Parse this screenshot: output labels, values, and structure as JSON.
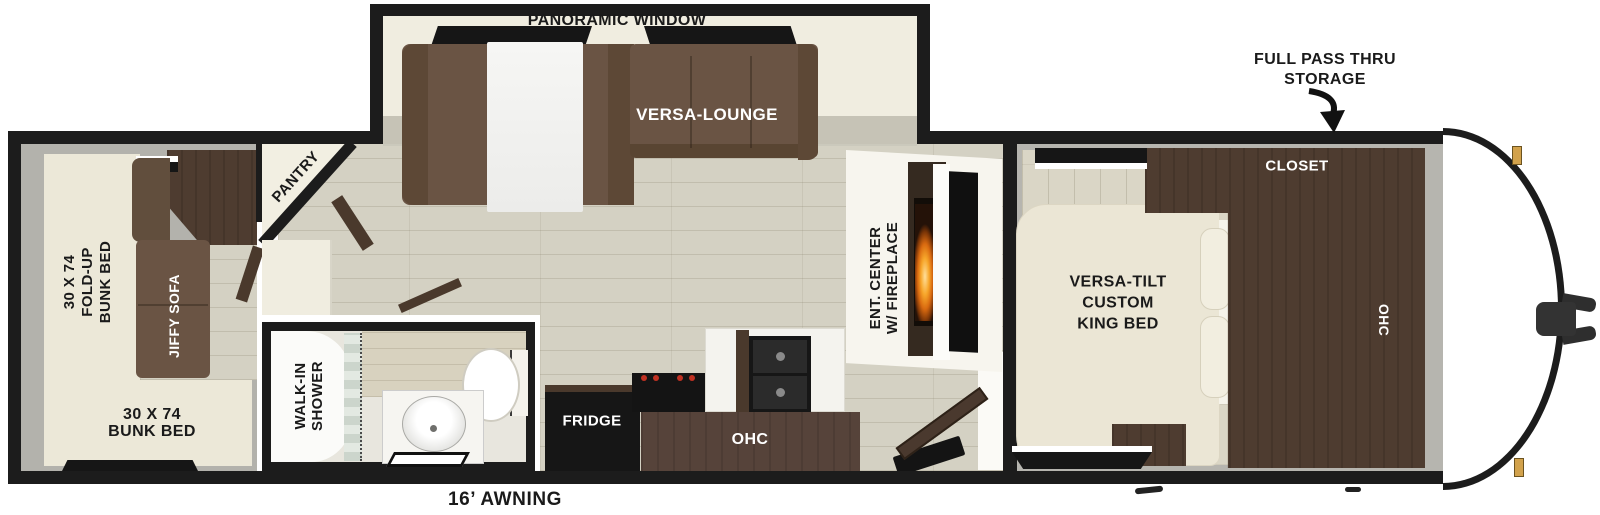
{
  "fp": {
    "slideout": {
      "window_label": "PANORAMIC WINDOW",
      "lounge_label": "VERSA-LOUNGE"
    },
    "storage": {
      "line1": "FULL PASS THRU",
      "line2": "STORAGE"
    },
    "bedroom": {
      "closet": "CLOSET",
      "bed1": "VERSA-TILT",
      "bed2": "CUSTOM",
      "bed3": "KING BED",
      "ohc": "OHC"
    },
    "living": {
      "ent1": "ENT. CENTER",
      "ent2": "W/ FIREPLACE",
      "pantry": "PANTRY"
    },
    "kitchen": {
      "fridge": "FRIDGE",
      "ohc": "OHC"
    },
    "bath": {
      "line1": "WALK-IN",
      "line2": "SHOWER"
    },
    "rear": {
      "fold1": "30 X 74",
      "fold2": "FOLD-UP",
      "fold3": "BUNK BED",
      "sofa": "JIFFY SOFA",
      "bunk1": "30 X 74",
      "bunk2": "BUNK BED"
    },
    "awning": "16’ AWNING",
    "colors": {
      "wall": "#1c1c1c",
      "sofa_brown": "#6a5444",
      "cabinet_brown": "#4e3c30",
      "flame_orange": "#f7a62a",
      "bed_cream": "#ebe6d5",
      "floor_wood": "#d4d1c3",
      "floor_grey": "#b5b4ae",
      "marker_gold": "#d2a24c"
    }
  }
}
